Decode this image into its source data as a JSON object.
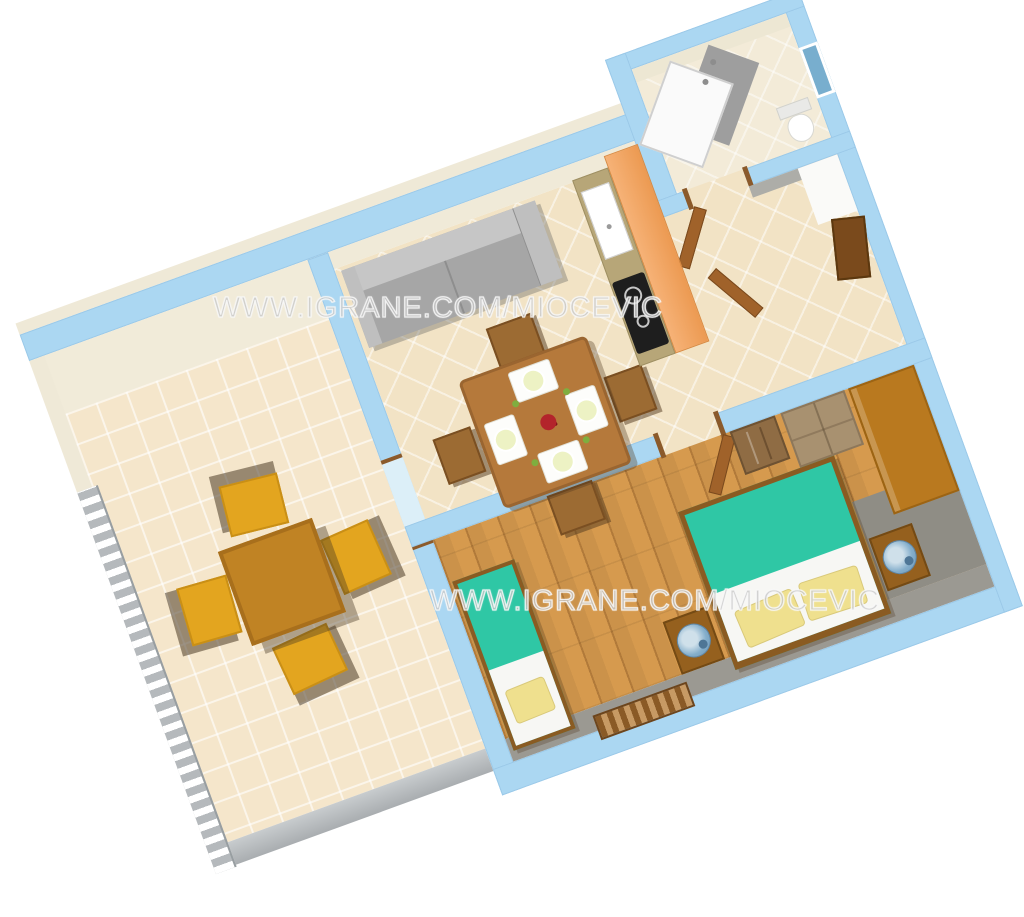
{
  "watermarks": {
    "top": "WWW.IGRANE.COM/MIOCEVIC",
    "bottom": "WWW.IGRANE.COM/MIOCEVIC"
  },
  "plan": {
    "type": "3d-apartment-floor-plan",
    "rotation_deg": -20,
    "rooms": [
      "terrace",
      "living-dining-room",
      "kitchen",
      "bathroom",
      "hall",
      "bedroom"
    ],
    "furniture": [
      "sofa",
      "dining-table",
      "dining-chairs",
      "place-settings",
      "terrace-table",
      "terrace-chairs",
      "terrace-railing",
      "kitchen-counter",
      "sink",
      "cooktop",
      "fridge-cabinet",
      "shower",
      "toilet",
      "window",
      "entry-door",
      "interior-doors",
      "double-bed",
      "single-bed",
      "pillows",
      "nightstands",
      "lamps",
      "wardrobe",
      "dresser",
      "small-cabinet",
      "radiator"
    ]
  },
  "palette": {
    "wall_blue": "#ABD7F2",
    "wall_face_beige": "#F0EAD8",
    "tile_beige": "#F2E3C5",
    "wood_floor": "#D69A4E",
    "bed_teal": "#2FC7A5",
    "pillow_yellow": "#EFE08E",
    "chair_yellow": "#E3A51F",
    "table_brown": "#B5793B",
    "cabinet_orange": "#F2A159",
    "railing_gray": "#B5B9BC",
    "shadow_gray": "#8F8D85",
    "window_blue": "#78AECE"
  }
}
